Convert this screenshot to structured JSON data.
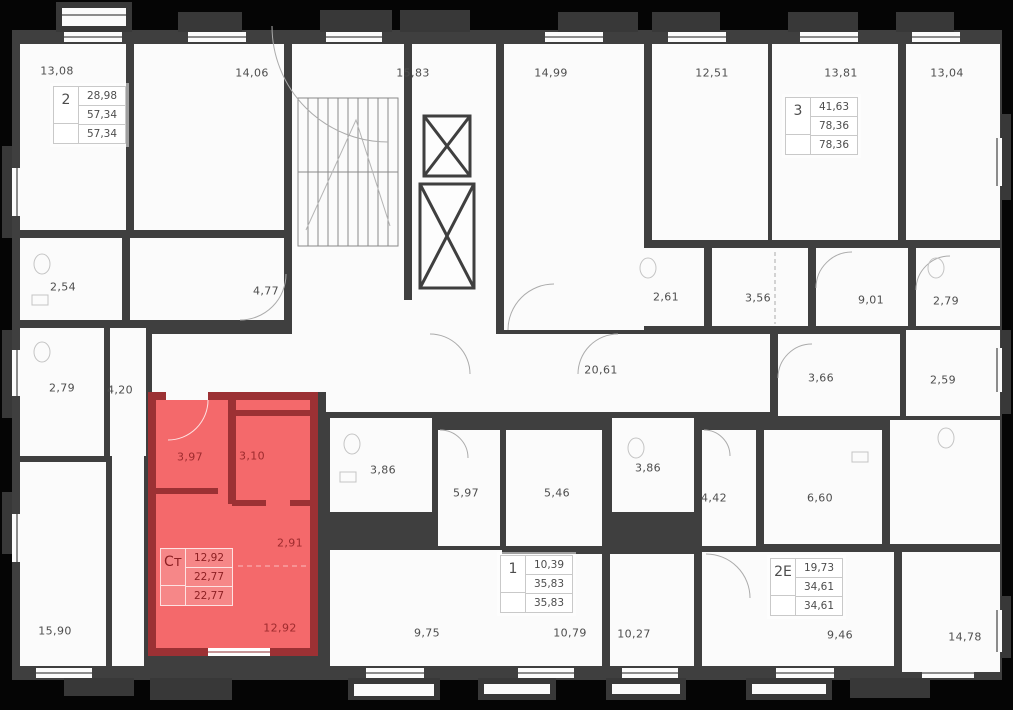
{
  "floor_plan": {
    "colors": {
      "background": "#050505",
      "wall": "#3f3f3f",
      "room": "#fbfbfb",
      "highlight_fill": "#f4696b",
      "highlight_wall": "#9c3134",
      "label_text": "#4d4d4d",
      "highlight_text": "#9e2b2e"
    },
    "room_labels": [
      {
        "value": "13,08",
        "x": 57,
        "y": 71
      },
      {
        "value": "14,06",
        "x": 252,
        "y": 73
      },
      {
        "value": "15,83",
        "x": 413,
        "y": 73
      },
      {
        "value": "14,99",
        "x": 551,
        "y": 73
      },
      {
        "value": "12,51",
        "x": 712,
        "y": 73
      },
      {
        "value": "13,81",
        "x": 841,
        "y": 73
      },
      {
        "value": "13,04",
        "x": 947,
        "y": 73
      },
      {
        "value": "2,54",
        "x": 63,
        "y": 287
      },
      {
        "value": "4,77",
        "x": 266,
        "y": 291
      },
      {
        "value": "2,61",
        "x": 666,
        "y": 297
      },
      {
        "value": "3,56",
        "x": 758,
        "y": 298
      },
      {
        "value": "9,01",
        "x": 871,
        "y": 300
      },
      {
        "value": "2,79",
        "x": 946,
        "y": 301
      },
      {
        "value": "2,79",
        "x": 62,
        "y": 388
      },
      {
        "value": "4,20",
        "x": 120,
        "y": 390
      },
      {
        "value": "20,61",
        "x": 601,
        "y": 370
      },
      {
        "value": "3,66",
        "x": 821,
        "y": 378
      },
      {
        "value": "2,59",
        "x": 943,
        "y": 380
      },
      {
        "value": "3,86",
        "x": 383,
        "y": 470
      },
      {
        "value": "5,97",
        "x": 466,
        "y": 493
      },
      {
        "value": "5,46",
        "x": 557,
        "y": 493
      },
      {
        "value": "3,86",
        "x": 648,
        "y": 468
      },
      {
        "value": "4,42",
        "x": 714,
        "y": 498
      },
      {
        "value": "6,60",
        "x": 820,
        "y": 498
      },
      {
        "value": "15,90",
        "x": 55,
        "y": 631
      },
      {
        "value": "9,75",
        "x": 427,
        "y": 633
      },
      {
        "value": "10,79",
        "x": 570,
        "y": 633
      },
      {
        "value": "10,27",
        "x": 634,
        "y": 634
      },
      {
        "value": "9,46",
        "x": 840,
        "y": 635
      },
      {
        "value": "14,78",
        "x": 965,
        "y": 637
      },
      {
        "value": "3,97",
        "x": 190,
        "y": 457,
        "highlight": true
      },
      {
        "value": "3,10",
        "x": 252,
        "y": 456,
        "highlight": true
      },
      {
        "value": "2,91",
        "x": 290,
        "y": 543,
        "highlight": true
      },
      {
        "value": "12,92",
        "x": 280,
        "y": 628,
        "highlight": true
      }
    ],
    "apartment_tables": [
      {
        "label": "2",
        "rows": [
          "28,98",
          "57,34",
          "57,34"
        ],
        "x": 53,
        "y": 86,
        "theme": "light"
      },
      {
        "label": "3",
        "rows": [
          "41,63",
          "78,36",
          "78,36"
        ],
        "x": 785,
        "y": 97,
        "theme": "light"
      },
      {
        "label": "Ст",
        "rows": [
          "12,92",
          "22,77",
          "22,77"
        ],
        "x": 160,
        "y": 548,
        "theme": "red"
      },
      {
        "label": "1",
        "rows": [
          "10,39",
          "35,83",
          "35,83"
        ],
        "x": 500,
        "y": 555,
        "theme": "light"
      },
      {
        "label": "2Е",
        "rows": [
          "19,73",
          "34,61",
          "34,61"
        ],
        "x": 770,
        "y": 558,
        "theme": "light"
      }
    ]
  }
}
